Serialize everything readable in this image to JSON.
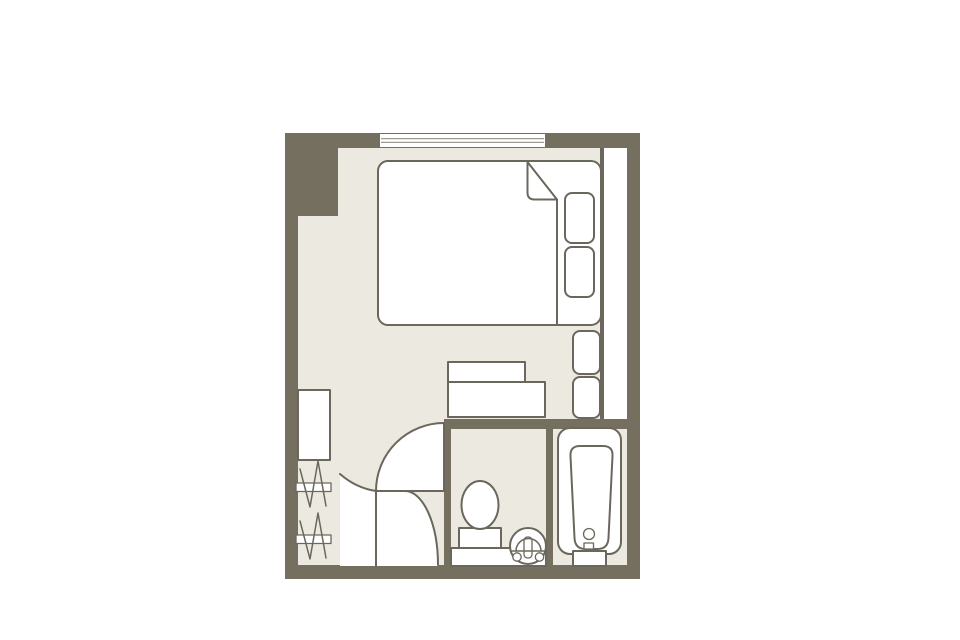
{
  "meta": {
    "kind": "hotel-room-floor-plan"
  },
  "colors": {
    "background": "#FFFFFF",
    "wall": "#756F60",
    "line": "#6B675C",
    "floor": "#ECEAE0",
    "white": "#FFFFFF"
  },
  "features": [
    "window",
    "double-bed",
    "duvet-fold",
    "pillow",
    "bench-seat",
    "desk",
    "luggage-rack",
    "clothes-hanger-rail",
    "entry-door-swing",
    "toilet-door-swing",
    "toilet",
    "washbasin",
    "vanity-counter",
    "bathtub",
    "bathtub-step",
    "side-shaft"
  ]
}
